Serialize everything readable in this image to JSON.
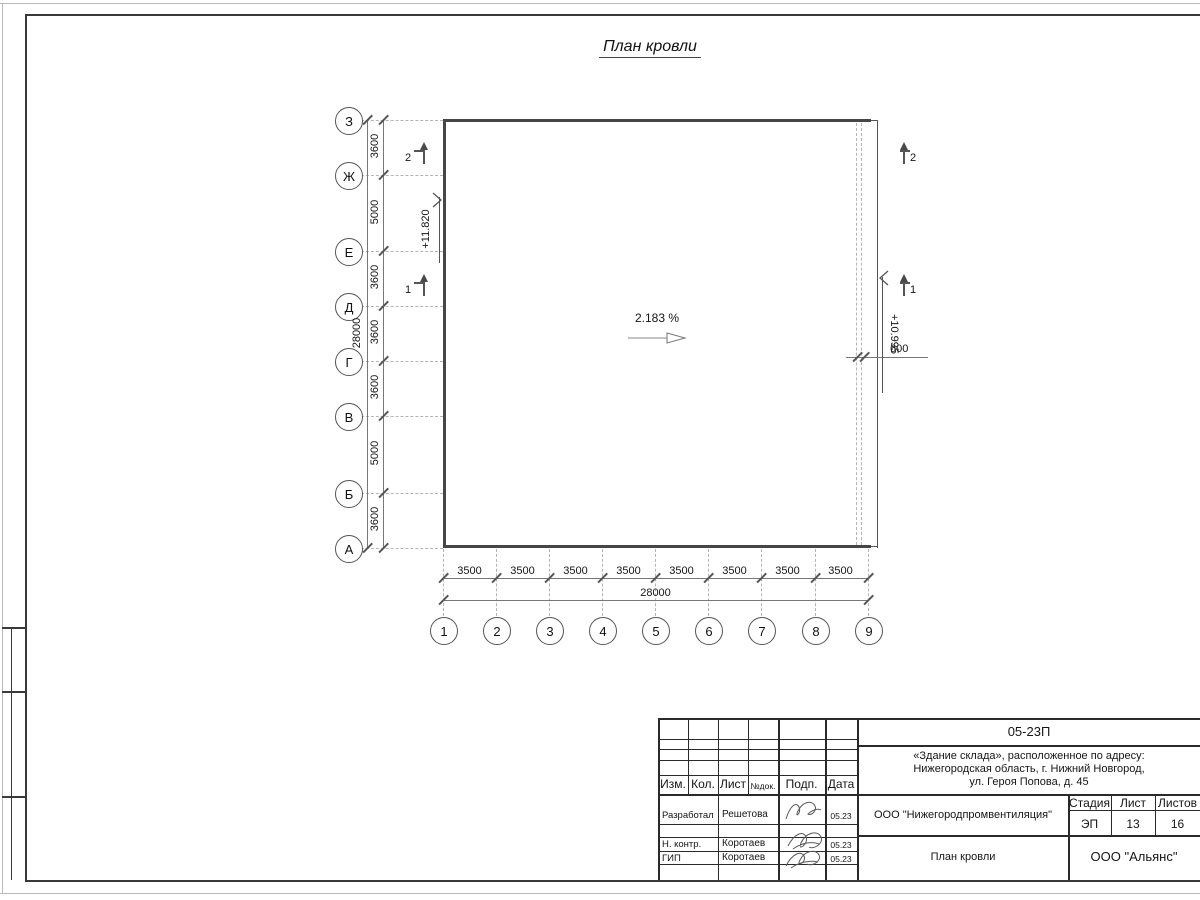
{
  "sheet": {
    "title": "План кровли"
  },
  "plan": {
    "slope": "2.183 %",
    "elevation_left": "+11.820",
    "elevation_right": "+10.995",
    "dim_600": "600",
    "sections": {
      "two": "2",
      "one": "1"
    },
    "axes_v": [
      "З",
      "Ж",
      "Е",
      "Д",
      "Г",
      "В",
      "Б",
      "А"
    ],
    "dims_v": [
      "3600",
      "5000",
      "3600",
      "3600",
      "3600",
      "5000",
      "3600"
    ],
    "total_v": "28000",
    "axes_h": [
      "1",
      "2",
      "3",
      "4",
      "5",
      "6",
      "7",
      "8",
      "9"
    ],
    "dims_h": [
      "3500",
      "3500",
      "3500",
      "3500",
      "3500",
      "3500",
      "3500",
      "3500"
    ],
    "total_h": "28000"
  },
  "titleblock": {
    "code": "05-23П",
    "project_line1": "«Здание склада», расположенное по адресу:",
    "project_line2": "Нижегородская область, г. Нижний Новгород,",
    "project_line3": "ул. Героя Попова, д. 45",
    "header": {
      "izm": "Изм.",
      "kol": "Кол.",
      "list": "Лист",
      "ndok": "№док.",
      "podp": "Подп.",
      "data": "Дата"
    },
    "rows": [
      {
        "role": "Разработал",
        "name": "Решетова",
        "date": "05.23"
      },
      {
        "role": "Н. контр.",
        "name": "Коротаев",
        "date": "05.23"
      },
      {
        "role": "ГИП",
        "name": "Коротаев",
        "date": "05.23"
      }
    ],
    "company": "ООО \"Нижегородпромвентиляция\"",
    "stage_label": "Стадия",
    "sheet_label": "Лист",
    "sheets_label": "Листов",
    "stage": "ЭП",
    "sheet": "13",
    "sheets": "16",
    "drawing_name": "План кровли",
    "org": "ООО \"Альянс\""
  }
}
